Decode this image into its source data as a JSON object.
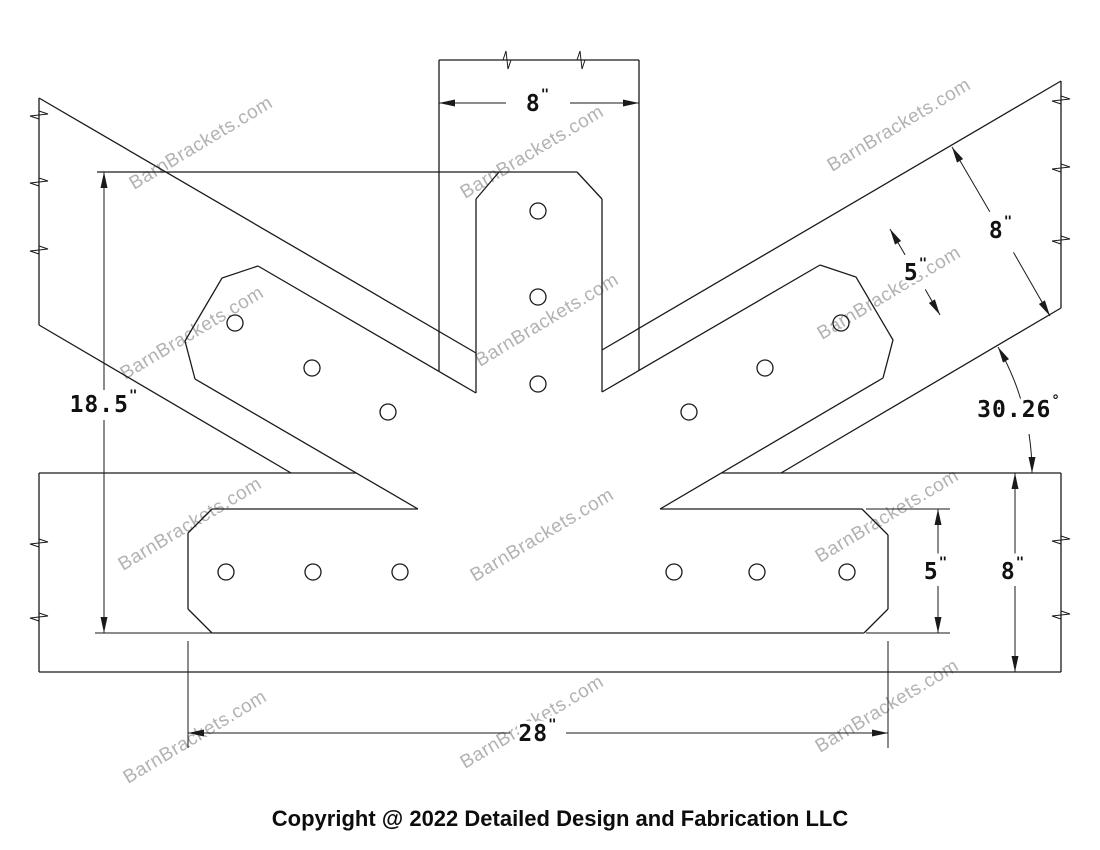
{
  "drawing": {
    "stroke_color": "#1a1a1a",
    "background_color": "#ffffff"
  },
  "watermark": {
    "text": "BarnBrackets.com",
    "color": "#b2b2b2"
  },
  "dimensions": {
    "post_width": {
      "value": "8",
      "unit": "\""
    },
    "strut_depth": {
      "value": "8",
      "unit": "\""
    },
    "strut_plate_width": {
      "value": "5",
      "unit": "\""
    },
    "bracket_height": {
      "value": "18.5",
      "unit": "\""
    },
    "strut_angle": {
      "value": "30.26",
      "unit": "°"
    },
    "band_plate_height": {
      "value": "5",
      "unit": "\""
    },
    "chord_depth": {
      "value": "8",
      "unit": "\""
    },
    "bracket_length": {
      "value": "28",
      "unit": "\""
    }
  },
  "footer": {
    "copyright": "Copyright @ 2022 Detailed Design and Fabrication LLC"
  }
}
